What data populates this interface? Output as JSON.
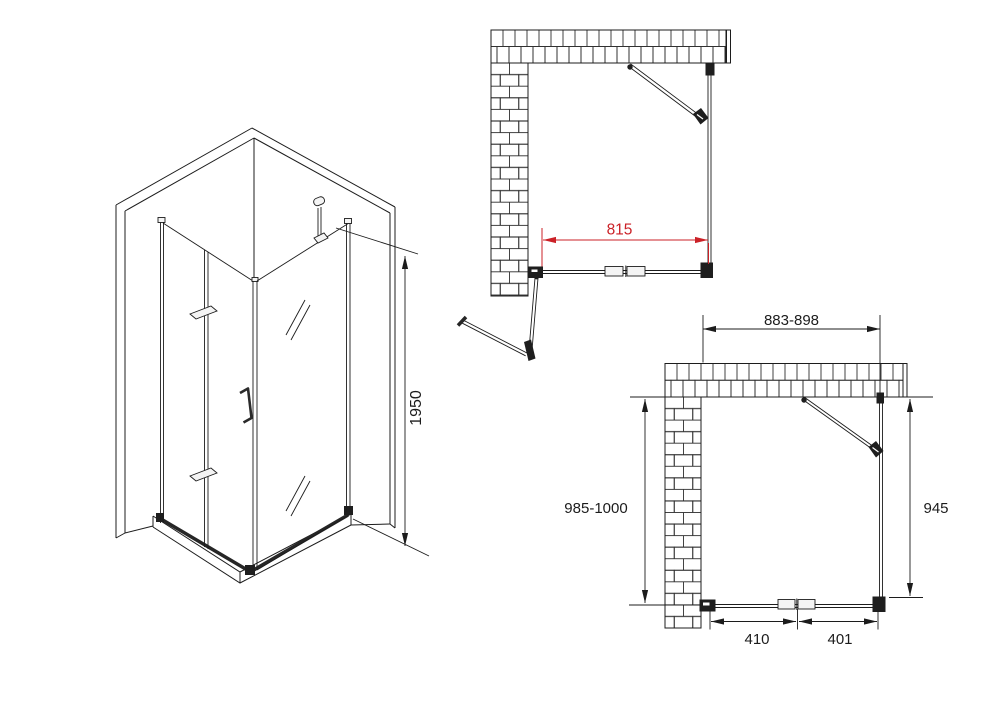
{
  "meta": {
    "drawing_type": "shower-enclosure-technical-drawing",
    "colors": {
      "background": "#ffffff",
      "line": "#1c1c1c",
      "dimension_red": "#cb2127"
    }
  },
  "views": {
    "isometric": {
      "height": "1950"
    },
    "plan_door_open": {
      "entry_width": "815"
    },
    "plan_door_closed": {
      "front_width_range": "883-898",
      "side_depth_range": "985-1000",
      "side_panel_width": "945",
      "door_half_left": "410",
      "door_half_right": "401"
    }
  }
}
